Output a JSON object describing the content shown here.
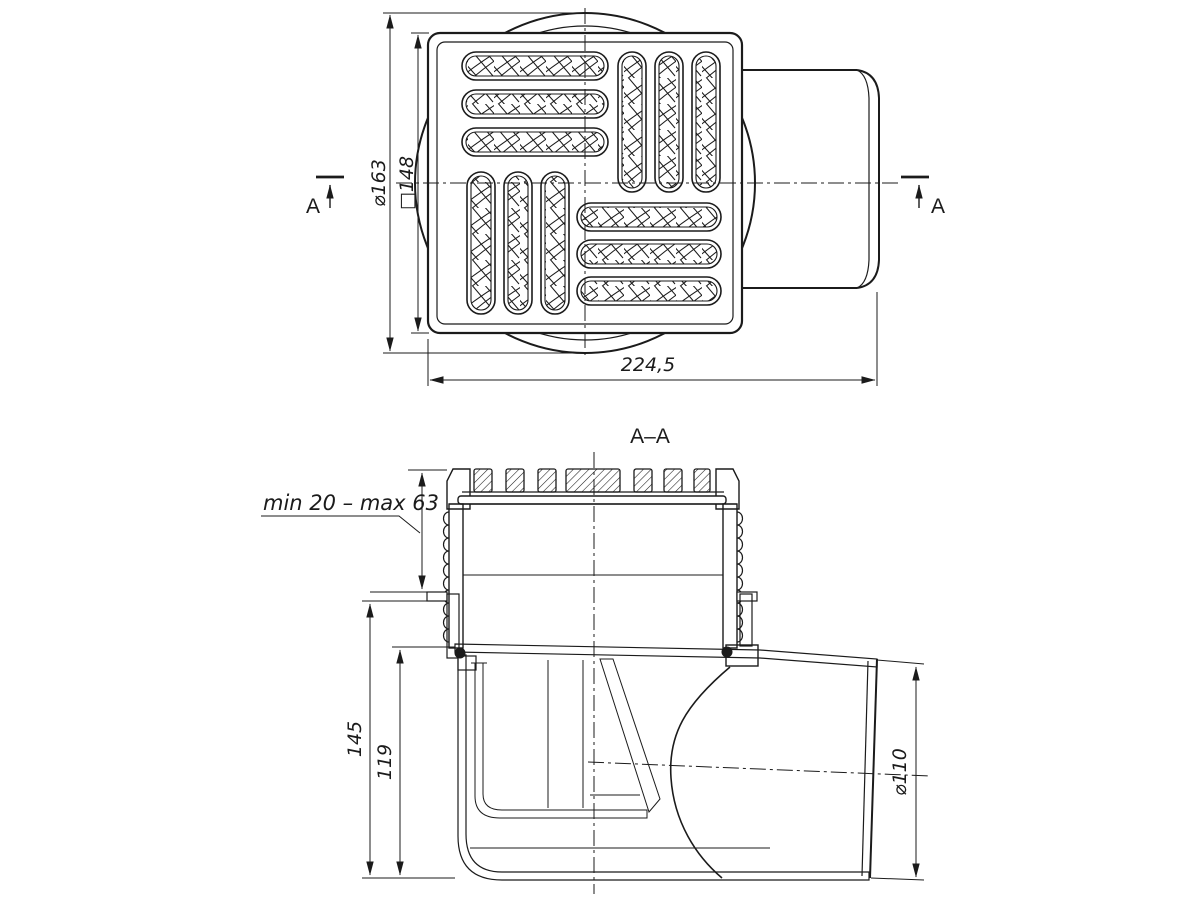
{
  "drawing": {
    "background": "#ffffff",
    "ink": "#1b1b1b",
    "views": {
      "top": {
        "label_flange_diameter": "⌀163",
        "label_grate_square": "□148",
        "label_overall_length": "224,5",
        "section_mark_left": "A",
        "section_mark_right": "A"
      },
      "section": {
        "title": "A–A",
        "label_adjust_range": "min 20 – max 63",
        "label_total_height": "145",
        "label_body_height": "119",
        "label_outlet_diameter": "⌀110"
      }
    }
  }
}
